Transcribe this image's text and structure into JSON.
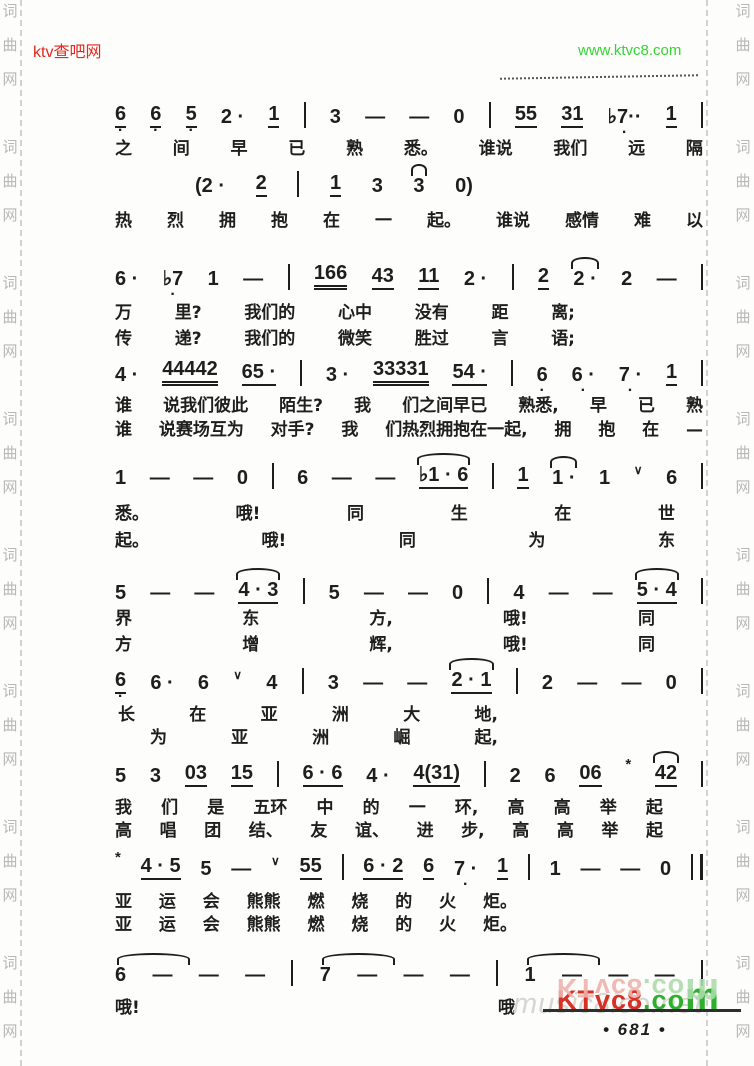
{
  "page": {
    "width": 754,
    "height": 1066,
    "background": "#fdfdfb",
    "ink": "#1e1e1e"
  },
  "header": {
    "left_watermark": {
      "text": "ktv查吧网",
      "color": "#e4281e"
    },
    "right_watermark": {
      "text": "www.ktvc8.com",
      "color": "#35d435"
    }
  },
  "side_watermark": {
    "chars": [
      "词",
      "曲",
      "网"
    ],
    "color": "#b8b8b8",
    "repeat": 8
  },
  "score": {
    "x": 115,
    "w": 588,
    "rows": [
      {
        "kind": "notes",
        "y": 98,
        "tokens": [
          "u,d:6",
          "u,d:6",
          "u,d:5",
          "2 ·",
          "u:1",
          "|",
          "3",
          "—",
          "—",
          "0",
          "|",
          "u:55",
          "u:31",
          "d:♭7··",
          "u:1",
          "|"
        ]
      },
      {
        "kind": "lyric",
        "y": 134,
        "tokens": [
          "之",
          "间",
          "早",
          "已",
          "熟",
          "悉。",
          "谁说",
          "我们",
          "远",
          "隔"
        ]
      },
      {
        "kind": "notes",
        "y": 167,
        "x": 195,
        "w": 278,
        "tokens": [
          "(2 ·",
          "u:2",
          "|",
          "u:1",
          "3",
          "arc:3",
          "0)"
        ]
      },
      {
        "kind": "lyric",
        "y": 206,
        "tokens": [
          "热",
          "烈",
          "拥",
          "抱",
          "在",
          "一",
          "起。",
          "谁说",
          "感情",
          "难",
          "以"
        ]
      },
      {
        "kind": "notes",
        "y": 260,
        "tokens": [
          "6 ·",
          "d:♭7",
          "1",
          "—",
          "|",
          "u2:166",
          "u:43",
          "u:11",
          "2 ·",
          "|",
          "u:2",
          "arc:2 ·",
          "2",
          "—",
          "|"
        ]
      },
      {
        "kind": "lyric",
        "y": 298,
        "w": 460,
        "tokens": [
          "万",
          "里?",
          "我们的",
          "心中",
          "没有",
          "距",
          "离;"
        ]
      },
      {
        "kind": "lyric",
        "y": 324,
        "w": 460,
        "tokens": [
          "传",
          "递?",
          "我们的",
          "微笑",
          "胜过",
          "言",
          "语;"
        ]
      },
      {
        "kind": "notes",
        "y": 356,
        "tokens": [
          "4 ·",
          "u2:44442",
          "u:65 ·",
          "|",
          "3 ·",
          "u2:33331",
          "u:54 ·",
          "|",
          "d:6",
          "d:6 ·",
          "d:7 ·",
          "u:1",
          "|"
        ]
      },
      {
        "kind": "lyric",
        "y": 391,
        "tokens": [
          "谁",
          "说我们彼此",
          "陌生?",
          "我",
          "们之间早已",
          "熟悉,",
          "早",
          "已",
          "熟"
        ]
      },
      {
        "kind": "lyric",
        "y": 415,
        "tokens": [
          "谁",
          "说赛场互为",
          "对手?",
          "我",
          "们热烈拥抱在一起,",
          "拥",
          "抱",
          "在",
          "—"
        ]
      },
      {
        "kind": "notes",
        "y": 459,
        "tokens": [
          "1",
          "—",
          "—",
          "0",
          "|",
          "6",
          "—",
          "—",
          "arc,u:♭1 · 6",
          "|",
          "u:1",
          "arc:1 ·",
          "1",
          "br:∨",
          "6",
          "|"
        ]
      },
      {
        "kind": "lyric",
        "y": 499,
        "w": 560,
        "tokens": [
          "悉。",
          "哦!",
          "同",
          "生",
          "在",
          "世"
        ]
      },
      {
        "kind": "lyric",
        "y": 526,
        "w": 560,
        "tokens": [
          "起。",
          "哦!",
          "同",
          "为",
          "东"
        ]
      },
      {
        "kind": "notes",
        "y": 574,
        "tokens": [
          "5",
          "—",
          "—",
          "arc,u:4 · 3",
          "|",
          "5",
          "—",
          "—",
          "0",
          "|",
          "4",
          "—",
          "—",
          "arc,u:5 · 4",
          "|"
        ]
      },
      {
        "kind": "lyric",
        "y": 604,
        "w": 540,
        "tokens": [
          "界",
          "东",
          "方,",
          "哦!",
          "同"
        ]
      },
      {
        "kind": "lyric",
        "y": 630,
        "w": 540,
        "tokens": [
          "方",
          "增",
          "辉,",
          "哦!",
          "同"
        ]
      },
      {
        "kind": "notes",
        "y": 664,
        "tokens": [
          "u,d:6",
          "6 ·",
          "6",
          "br:∨",
          "4",
          "|",
          "3",
          "—",
          "—",
          "arc,u:2 · 1",
          "|",
          "2",
          "—",
          "—",
          "0",
          "|"
        ]
      },
      {
        "kind": "lyric",
        "y": 700,
        "x": 118,
        "w": 380,
        "tokens": [
          "长",
          "在",
          "亚",
          "洲",
          "大",
          "地,"
        ]
      },
      {
        "kind": "lyric",
        "y": 723,
        "x": 150,
        "w": 348,
        "tokens": [
          "为",
          "亚",
          "洲",
          "崛",
          "起,"
        ]
      },
      {
        "kind": "notes",
        "y": 757,
        "tokens": [
          "5",
          "3",
          "u:03",
          "u:15",
          "|",
          "u:6 · 6",
          "4 ·",
          "u:4(31)",
          "|",
          "2",
          "6",
          "u:06",
          "ast:*",
          "arc,u:42",
          "|"
        ]
      },
      {
        "kind": "lyric",
        "y": 793,
        "w": 548,
        "tokens": [
          "我",
          "们",
          "是",
          "五环",
          "中",
          "的",
          "一",
          "环,",
          "高",
          "高",
          "举",
          "起"
        ]
      },
      {
        "kind": "lyric",
        "y": 816,
        "w": 548,
        "tokens": [
          "高",
          "唱",
          "团",
          "结、",
          "友",
          "谊、",
          "进",
          "步,",
          "高",
          "高",
          "举",
          "起"
        ]
      },
      {
        "kind": "notes",
        "y": 850,
        "tokens": [
          "ast:*",
          "u:4 · 5",
          "5",
          "—",
          "br:∨",
          "u:55",
          "|",
          "u:6 · 2",
          "u:6",
          "d:7 ·",
          "u:1",
          "|",
          "1",
          "—",
          "—",
          "0",
          "‖"
        ]
      },
      {
        "kind": "lyric",
        "y": 887,
        "w": 402,
        "tokens": [
          "亚",
          "运",
          "会",
          "熊熊",
          "燃",
          "烧",
          "的",
          "火",
          "炬。"
        ]
      },
      {
        "kind": "lyric",
        "y": 910,
        "w": 402,
        "tokens": [
          "亚",
          "运",
          "会",
          "熊熊",
          "燃",
          "烧",
          "的",
          "火",
          "炬。"
        ]
      },
      {
        "kind": "notes",
        "y": 956,
        "tokens": [
          "arcw:6",
          "—",
          "—",
          "—",
          "|",
          "arcw:7",
          "—",
          "—",
          "—",
          "|",
          "arcw:1",
          "—",
          "—",
          "—",
          "|"
        ]
      },
      {
        "kind": "lyric",
        "y": 993,
        "w": 400,
        "tokens": [
          "哦!",
          "哦"
        ]
      }
    ]
  },
  "footer": {
    "logo": {
      "main_red": "KTvc8",
      "main_dot": ".co",
      "main_m": "m",
      "red": "#d93025",
      "green": "#2eaf2e",
      "reflection_red": "#f0b2ac",
      "reflection_green": "#abdcab"
    },
    "background_watermark": {
      "text": "music8ico.net",
      "color": "#d6d6d0"
    },
    "page_number": "• 681 •"
  }
}
